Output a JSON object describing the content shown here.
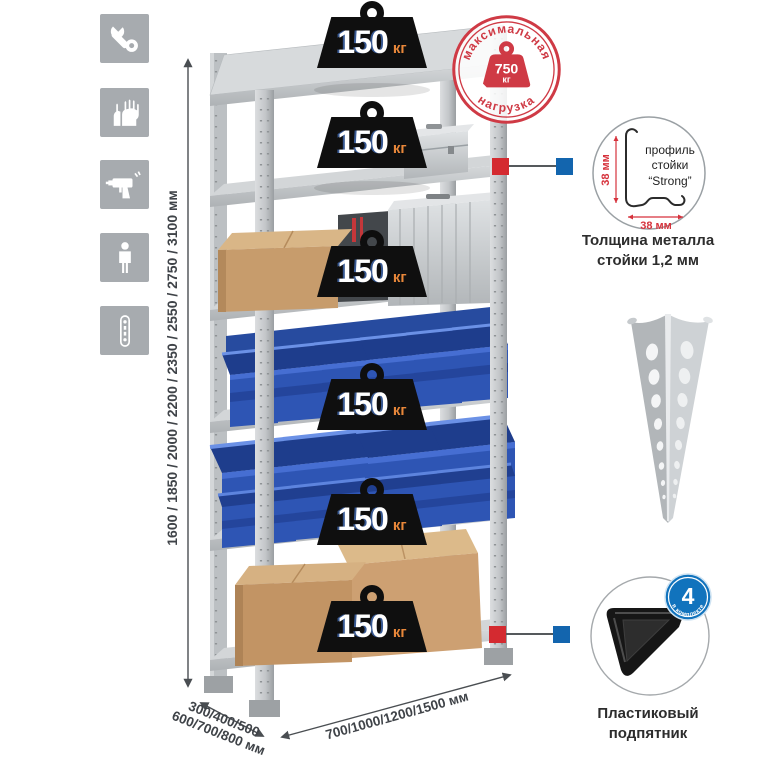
{
  "colors": {
    "accent_red": "#d42a30",
    "accent_blue": "#1365ae",
    "stamp_red": "#cf3a45",
    "weight_black": "#0f0f0f",
    "weight_unit_orange": "#e8873a",
    "icon_tile_gray": "#a7abaf",
    "metal_light": "#d8dadc",
    "metal_mid": "#c3c6c9",
    "bin_blue": "#2e55b4",
    "bin_blue_dark": "#1e3d8c",
    "cardboard": "#c79c6c",
    "badge_blue": "#1173bd",
    "text_dark": "#3f4348"
  },
  "sidebar_icons": [
    {
      "name": "wrench-icon"
    },
    {
      "name": "gloves-icon"
    },
    {
      "name": "drill-icon"
    },
    {
      "name": "person-icon"
    },
    {
      "name": "post-profile-icon"
    }
  ],
  "dimensions": {
    "height": "1600 / 1850 / 2000 / 2200 / 2350 / 2550 / 2750 / 3100 мм",
    "depth_line1": "300/400/500",
    "depth_line2": "600/700/800 мм",
    "width": "700/1000/1200/1500 мм"
  },
  "weights": {
    "items": [
      {
        "value": "150",
        "unit": "кг"
      },
      {
        "value": "150",
        "unit": "кг"
      },
      {
        "value": "150",
        "unit": "кг"
      },
      {
        "value": "150",
        "unit": "кг"
      },
      {
        "value": "150",
        "unit": "кг"
      },
      {
        "value": "150",
        "unit": "кг"
      }
    ]
  },
  "max_load_stamp": {
    "arc_top": "максимальная",
    "arc_bottom": "нагрузка",
    "value": "750",
    "unit": "кг"
  },
  "profile_detail": {
    "label_line1": "профиль",
    "label_line2": "стойки",
    "label_line3": "“Strong”",
    "dim_vertical": "38 мм",
    "dim_horizontal": "38 мм",
    "caption_line1": "Толщина металла",
    "caption_line2": "стойки 1,2 мм"
  },
  "foot_detail": {
    "badge_value": "4",
    "badge_arc": "в комплекте",
    "caption_line1": "Пластиковый",
    "caption_line2": "подпятник"
  }
}
